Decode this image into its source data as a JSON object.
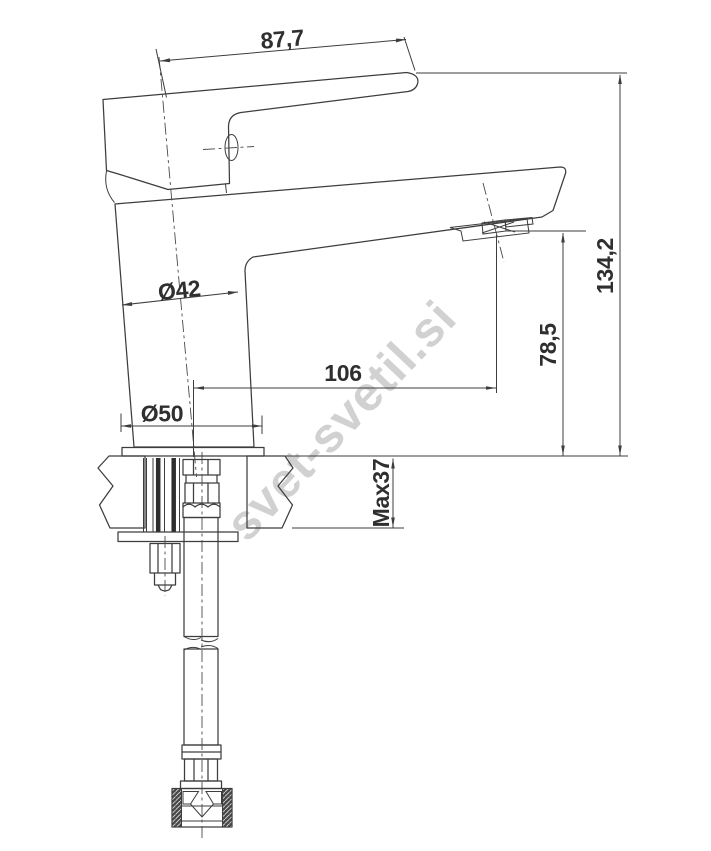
{
  "drawing": {
    "type": "technical-dimension-drawing",
    "subject": "single-lever basin mixer faucet, side view with countertop cross-section and flexible supply hose",
    "watermark": "svet-svetil.si",
    "dims": {
      "handle_projection": "87,7",
      "overall_height": "134,2",
      "spout_outlet_height": "78,5",
      "spout_reach": "106",
      "body_diameter": "Ø42",
      "base_diameter": "Ø50",
      "max_mounting_thickness": "Max37"
    },
    "colors": {
      "line": "#3d3d3d",
      "dimension_text": "#2f2f2f",
      "watermark": "#c9c9c9",
      "background": "#ffffff"
    }
  }
}
